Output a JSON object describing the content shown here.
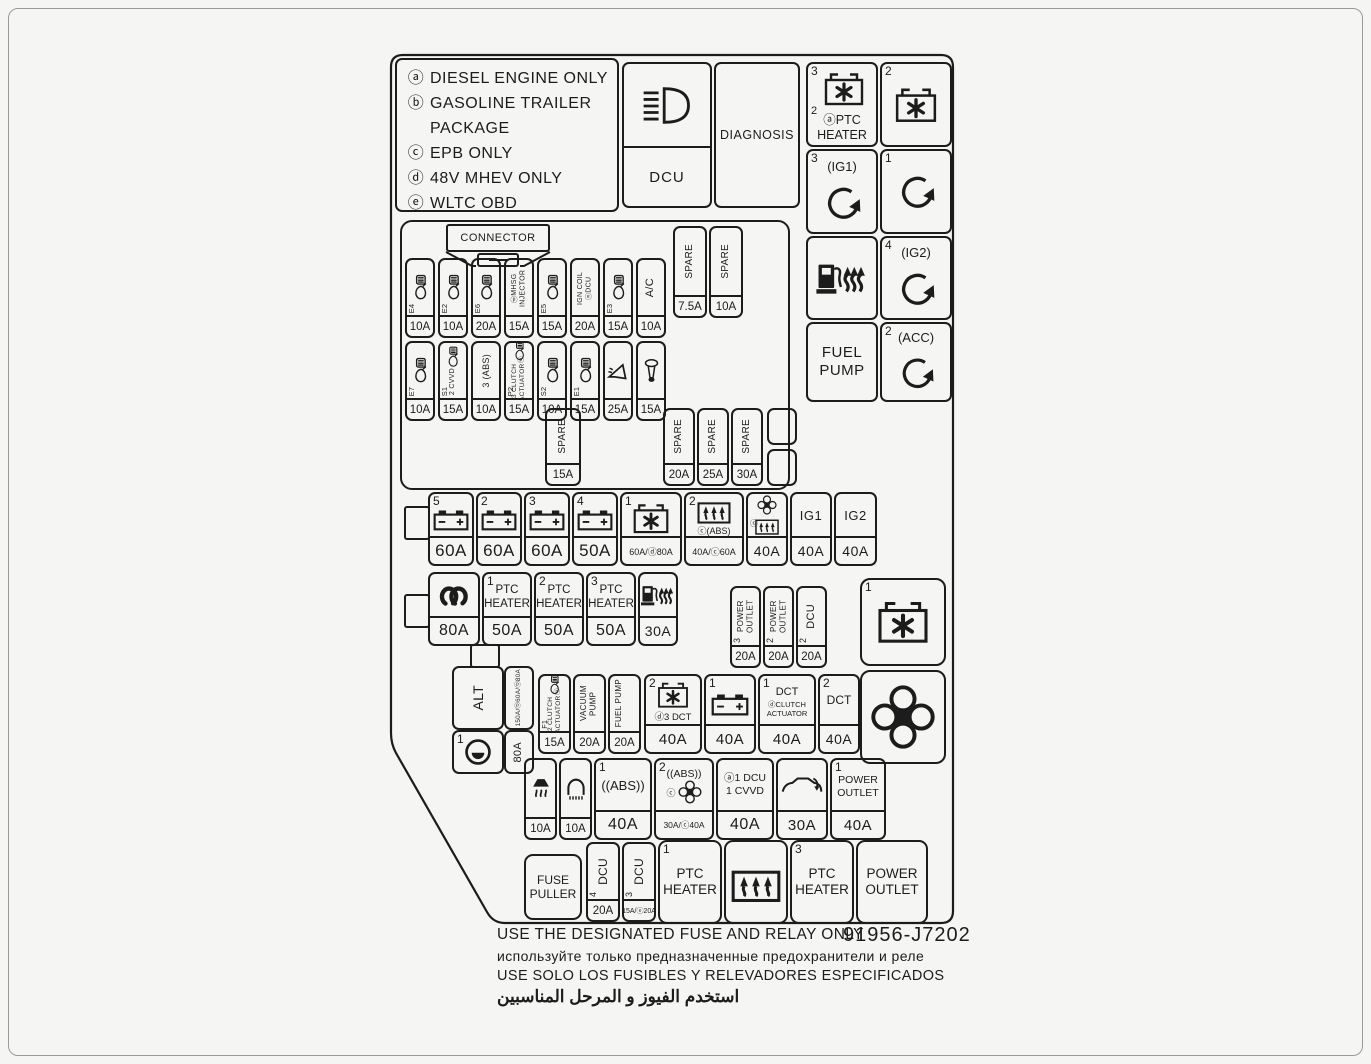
{
  "legend": {
    "lines": [
      {
        "key": "ⓐ",
        "text": "DIESEL ENGINE ONLY"
      },
      {
        "key": "ⓑ",
        "text": "GASOLINE TRAILER"
      },
      {
        "key": "",
        "text": "PACKAGE"
      },
      {
        "key": "ⓒ",
        "text": "EPB ONLY"
      },
      {
        "key": "ⓓ",
        "text": "48V MHEV ONLY"
      },
      {
        "key": "ⓔ",
        "text": "WLTC OBD"
      }
    ]
  },
  "top_box": {
    "dcu": "DCU",
    "diagnosis": "DIAGNOSIS",
    "icon": "low-beam-headlight-icon"
  },
  "relay_column": {
    "ptc_relay": {
      "n_top": "3",
      "n_mid": "2",
      "label1": "ⓐPTC",
      "label2": "HEATER",
      "icon": "fan-box-icon"
    },
    "relay_2": {
      "n": "2",
      "icon": "fan-box-icon"
    },
    "ig1_relay": {
      "n": "3",
      "label": "(IG1)",
      "icon": "rotary-start-icon"
    },
    "relay_1": {
      "n": "1",
      "icon": "rotary-start-icon"
    },
    "fuel_heater": {
      "icon": "fuel-pump-heater-icon"
    },
    "ig2_relay": {
      "n": "4",
      "label": "(IG2)",
      "icon": "rotary-start-icon"
    },
    "fuel_pump": {
      "line1": "FUEL",
      "line2": "PUMP"
    },
    "acc_relay": {
      "n": "2",
      "label": "(ACC)",
      "icon": "rotary-start-icon"
    }
  },
  "connector": {
    "label": "CONNECTOR",
    "icon": "mini-fuse-icon"
  },
  "spares_top": [
    {
      "label": "SPARE",
      "amp": "7.5A"
    },
    {
      "label": "SPARE",
      "amp": "10A"
    }
  ],
  "spare_mid": {
    "label": "SPARE",
    "amp": "15A"
  },
  "spares_low": [
    {
      "label": "SPARE",
      "amp": "20A"
    },
    {
      "label": "SPARE",
      "amp": "25A"
    },
    {
      "label": "SPARE",
      "amp": "30A"
    }
  ],
  "row_a": [
    {
      "sub": "E4",
      "icon": "injector-icon",
      "amp": "10A"
    },
    {
      "sub": "E2",
      "icon": "injector-icon",
      "amp": "10A"
    },
    {
      "sub": "E6",
      "icon": "injector-icon",
      "amp": "20A"
    },
    {
      "label": "ⓓMHSG INJECTOR",
      "icon": "injector-icon",
      "amp": "15A"
    },
    {
      "sub": "E5",
      "icon": "injector-icon",
      "amp": "15A"
    },
    {
      "label": "IGN COIL ⓐDCU",
      "amp": "20A"
    },
    {
      "sub": "E3",
      "icon": "injector-icon",
      "amp": "15A"
    },
    {
      "label": "A/C",
      "amp": "10A"
    }
  ],
  "row_b": [
    {
      "sub": "E7",
      "icon": "injector-icon",
      "amp": "10A"
    },
    {
      "sub": "S1",
      "label": "2 CVVD",
      "icon": "injector-icon",
      "amp": "15A"
    },
    {
      "label": "3 (ABS)",
      "amp": "10A"
    },
    {
      "sub": "P2",
      "label": "3 CLUTCH ACTUATORⓓ",
      "icon": "injector-icon",
      "amp": "15A"
    },
    {
      "sub": "S2",
      "icon": "injector-icon",
      "amp": "10A"
    },
    {
      "sub": "E1",
      "icon": "injector-icon",
      "amp": "15A"
    },
    {
      "icon": "horn-icon",
      "amp": "25A"
    },
    {
      "icon": "siren-horn-icon",
      "amp": "15A"
    }
  ],
  "row_main": [
    {
      "n": "5",
      "icon": "battery-icon",
      "amp": "60A"
    },
    {
      "n": "2",
      "icon": "battery-icon",
      "amp": "60A"
    },
    {
      "n": "3",
      "icon": "battery-icon",
      "amp": "60A"
    },
    {
      "n": "4",
      "icon": "battery-icon",
      "amp": "50A"
    },
    {
      "n": "1",
      "icon": "fan-box-icon",
      "amp": "60A/ⓓ80A"
    },
    {
      "n": "2",
      "label": "ⓒ(ABS)",
      "icon": "rear-defrost-icon",
      "amp": "40A/ⓒ60A"
    },
    {
      "label": "ⓒ",
      "icon": "cooling-fan-icon",
      "amp": "40A"
    },
    {
      "label": "IG1",
      "amp": "40A"
    },
    {
      "label": "IG2",
      "amp": "40A"
    }
  ],
  "row_ptc": [
    {
      "icon": "glow-plug-icon",
      "amp": "80A"
    },
    {
      "n": "1",
      "line1": "PTC",
      "line2": "HEATER",
      "amp": "50A"
    },
    {
      "n": "2",
      "line1": "PTC",
      "line2": "HEATER",
      "amp": "50A"
    },
    {
      "n": "3",
      "line1": "PTC",
      "line2": "HEATER",
      "amp": "50A"
    },
    {
      "icon": "fuel-pump-heater-icon",
      "amp": "30A"
    }
  ],
  "outlet_group": [
    {
      "n": "3",
      "label": "POWER OUTLET",
      "amp": "20A"
    },
    {
      "n": "2",
      "label": "POWER OUTLET",
      "amp": "20A"
    },
    {
      "n": "2",
      "label": "DCU",
      "amp": "20A"
    }
  ],
  "relay_big": {
    "n": "1",
    "icon": "fan-box-icon"
  },
  "fan_box": {
    "icon": "cooling-fan-icon"
  },
  "alt": {
    "label": "ALT",
    "amp_top": "150A/ⓓ60A/ⓓ80A",
    "n": "1",
    "icon": "alternator-icon",
    "amp_bottom": "80A"
  },
  "row_mid": [
    {
      "sub": "F1",
      "label": "2 CLUTCH ACTUATORⓓ",
      "icon": "injector-icon",
      "amp": "15A"
    },
    {
      "label": "VACUUM PUMP",
      "amp": "20A"
    },
    {
      "label": "FUEL PUMP",
      "amp": "20A"
    },
    {
      "n": "2",
      "label": "ⓓ3 DCT",
      "icon": "fan-box-icon",
      "amp": "40A"
    },
    {
      "n": "1",
      "icon": "battery-icon",
      "amp": "40A"
    },
    {
      "n": "1",
      "line1": "DCT",
      "line2": "ⓓCLUTCH",
      "line3": "ACTUATOR",
      "amp": "40A"
    },
    {
      "n": "2",
      "label": "DCT",
      "amp": "40A"
    }
  ],
  "row_low": [
    {
      "icon": "heater-blower-icon",
      "amp": "10A"
    },
    {
      "icon": "lamp-icon",
      "amp": "10A"
    },
    {
      "n": "1",
      "label": "((ABS))",
      "amp": "40A"
    },
    {
      "n": "2",
      "label": "((ABS))",
      "sub": "ⓒ",
      "icon": "cooling-fan-icon",
      "amp": "30A/ⓒ40A"
    },
    {
      "line1": "ⓐ1 DCU",
      "line2": "1 CVVD",
      "amp": "40A"
    },
    {
      "icon": "vehicle-icon",
      "amp": "30A"
    },
    {
      "n": "1",
      "line1": "POWER",
      "line2": "OUTLET",
      "amp": "40A"
    }
  ],
  "bottom_row": {
    "fuse_puller": {
      "line1": "FUSE",
      "line2": "PULLER"
    },
    "dcu4": {
      "label": "DCU",
      "n": "4",
      "amp": "20A",
      "icon": "fuse-icon"
    },
    "dcu3": {
      "label": "DCU",
      "n": "3",
      "amp": "15A/ⓔ20A",
      "icon": "fuse-icon"
    },
    "ptc1": {
      "n": "1",
      "line1": "PTC",
      "line2": "HEATER"
    },
    "defrost": {
      "icon": "rear-defrost-icon"
    },
    "ptc3": {
      "n": "3",
      "line1": "PTC",
      "line2": "HEATER"
    },
    "outlet": {
      "line1": "POWER",
      "line2": "OUTLET"
    }
  },
  "footer": {
    "en": "USE THE DESIGNATED FUSE AND RELAY ONLY",
    "part_number": "91956-J7202",
    "ru": "используйте только предназначенные предохранители и реле",
    "es": "USE SOLO LOS FUSIBLES Y RELEVADORES ESPECIFICADOS",
    "ar": "استخدم الفيوز و المرحل المناسبين"
  }
}
